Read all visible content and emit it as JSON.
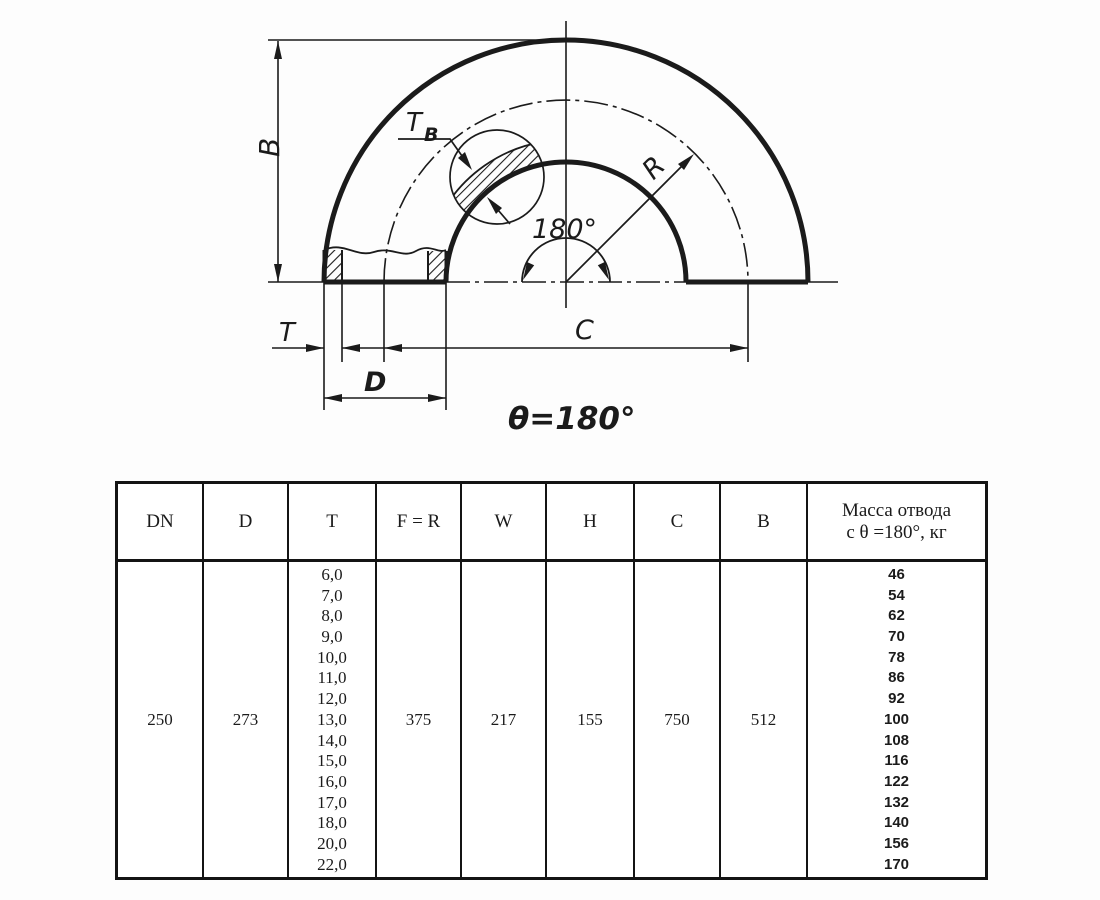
{
  "colors": {
    "ink": "#1b1b1b",
    "background": "#fdfdfd"
  },
  "drawing": {
    "labels": {
      "b": "B",
      "t": "T",
      "d": "D",
      "c": "C",
      "r": "R",
      "angle": "180°",
      "theta_equation": "θ=180°",
      "tb_main": "T",
      "tb_sub": "B"
    }
  },
  "table": {
    "headers": [
      "DN",
      "D",
      "T",
      "F = R",
      "W",
      "H",
      "C",
      "B"
    ],
    "mass_header_line1": "Масса отвода",
    "mass_header_line2": "с θ =180°, кг",
    "row": {
      "dn": "250",
      "d": "273",
      "t_values": [
        "6,0",
        "7,0",
        "8,0",
        "9,0",
        "10,0",
        "11,0",
        "12,0",
        "13,0",
        "14,0",
        "15,0",
        "16,0",
        "17,0",
        "18,0",
        "20,0",
        "22,0"
      ],
      "f_r": "375",
      "w": "217",
      "h": "155",
      "c": "750",
      "b": "512",
      "mass_values": [
        "46",
        "54",
        "62",
        "70",
        "78",
        "86",
        "92",
        "100",
        "108",
        "116",
        "122",
        "132",
        "140",
        "156",
        "170"
      ]
    }
  }
}
